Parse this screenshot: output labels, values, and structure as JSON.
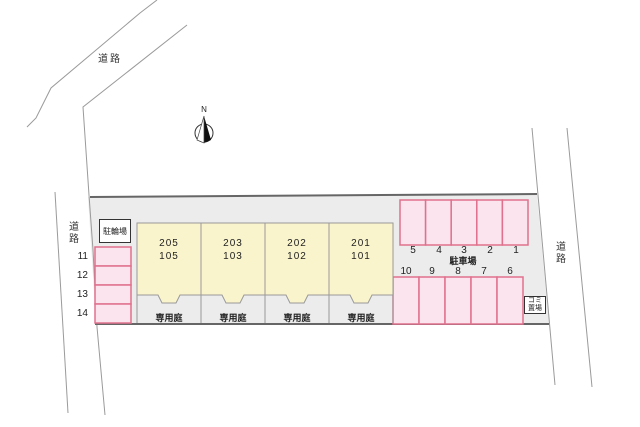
{
  "title": "apartment-site-plan",
  "colors": {
    "site_fill": "#ececec",
    "boundary_line": "#666666",
    "road_line": "#9a9a9a",
    "stall_fill": "#fce4ee",
    "stall_border": "#e0718d",
    "unit_fill": "#faf4cc",
    "unit_border": "#999999"
  },
  "roads": {
    "top_label": "道路",
    "left_label": "道路",
    "right_label": "道路"
  },
  "compass": {
    "label": "N"
  },
  "facilities": {
    "bicycle_parking": "駐輪場",
    "parking_lot": "駐車場",
    "garbage_line1": "ゴミ",
    "garbage_line2": "置場",
    "private_garden": "専用庭"
  },
  "units": [
    {
      "upper": "205",
      "lower": "105"
    },
    {
      "upper": "203",
      "lower": "103"
    },
    {
      "upper": "202",
      "lower": "102"
    },
    {
      "upper": "201",
      "lower": "101"
    }
  ],
  "parking": {
    "top_row": [
      "5",
      "4",
      "3",
      "2",
      "1"
    ],
    "bottom_row": [
      "10",
      "9",
      "8",
      "7",
      "6"
    ],
    "side_column": [
      "11",
      "12",
      "13",
      "14"
    ]
  }
}
